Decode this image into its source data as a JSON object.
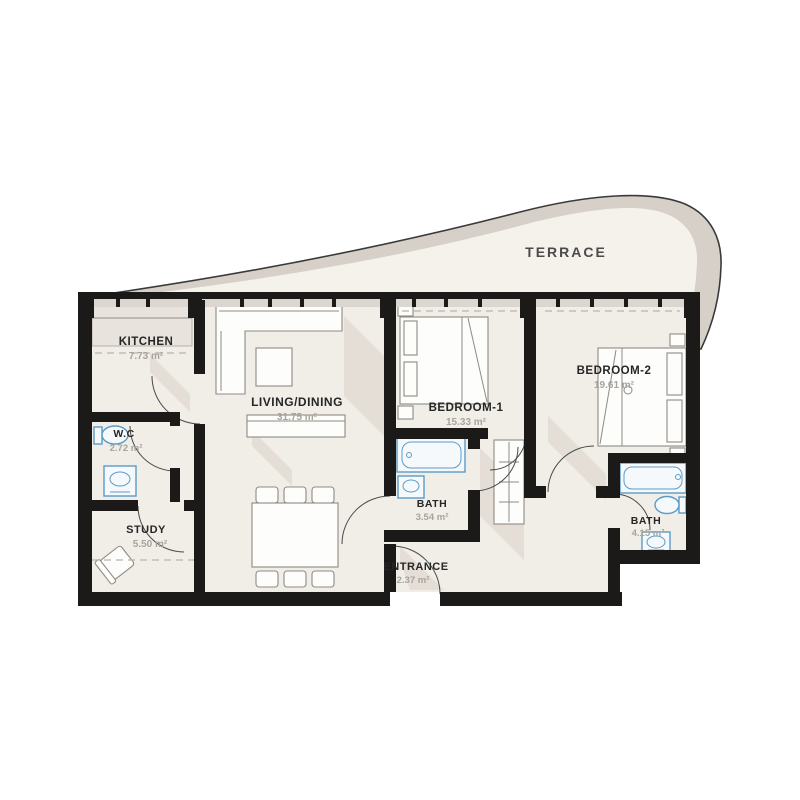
{
  "terrace": {
    "label": "TERRACE"
  },
  "rooms": {
    "kitchen": {
      "name": "KITCHEN",
      "area": "7.73 m²"
    },
    "living": {
      "name": "LIVING/DINING",
      "area": "31.75 m²"
    },
    "wc": {
      "name": "W.C",
      "area": "2.72 m²"
    },
    "study": {
      "name": "STUDY",
      "area": "5.50 m²"
    },
    "bedroom1": {
      "name": "BEDROOM-1",
      "area": "15.33 m²"
    },
    "bath1": {
      "name": "BATH",
      "area": "3.54 m²"
    },
    "entrance": {
      "name": "ENTRANCE",
      "area": "2.37 m²"
    },
    "bedroom2": {
      "name": "BEDROOM-2",
      "area": "19.61 m²"
    },
    "bath2": {
      "name": "BATH",
      "area": "4.15 m²"
    }
  },
  "colors": {
    "wall": "#1c1a19",
    "floor": "#f1eee8",
    "terrace_band": "#d6d0c8",
    "terrace_floor": "#f5f2ec",
    "fixture_stroke": "#5b9bc8",
    "shadow": "#d8d2c9",
    "label_text": "#262626",
    "area_text": "#a8a39c"
  }
}
